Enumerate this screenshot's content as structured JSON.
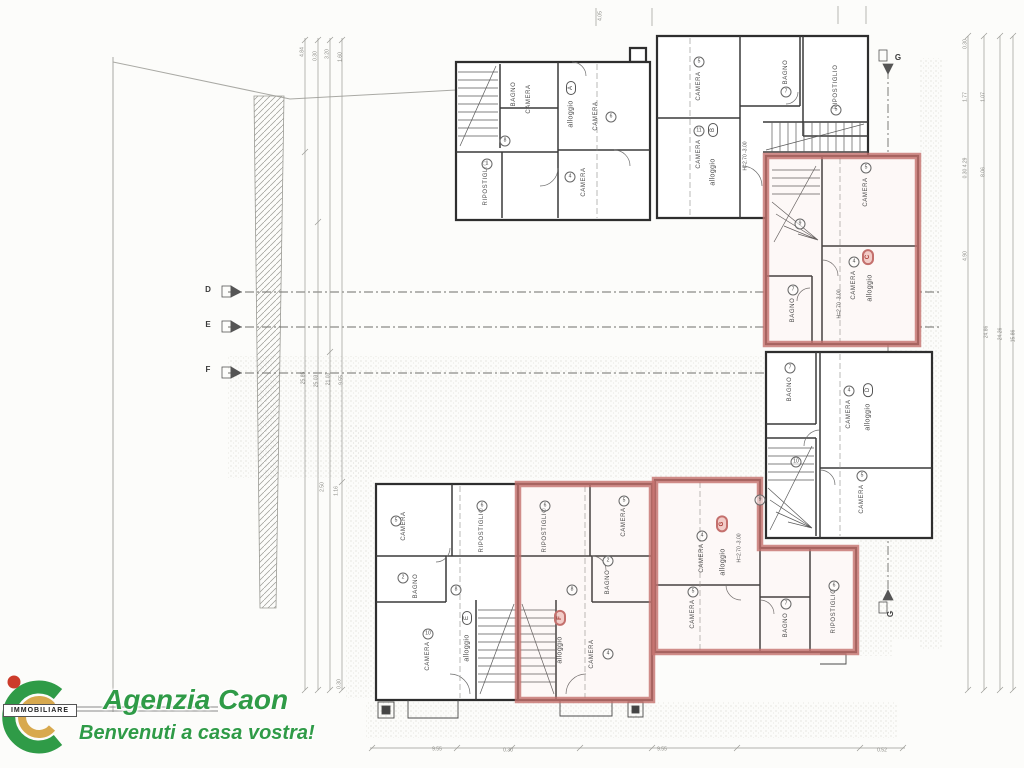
{
  "branding": {
    "agency_name": "Agenzia Caon",
    "tagline": "Benvenuti a casa vostra!",
    "logo_banner": "IMMOBILIARE",
    "brand_green": "#2f9b47",
    "brand_gold": "#d8a94e",
    "brand_red": "#cc3b2a"
  },
  "plan": {
    "type": "floor-plan-scan",
    "highlight_color": "#c4706d",
    "room_types": [
      "CAMERA",
      "BAGNO",
      "RIPOSTIGLIO",
      "alloggio"
    ],
    "highlighted_units": [
      "C",
      "F",
      "G"
    ],
    "labels": [
      {
        "t": "BAGNO",
        "x": 514,
        "y": 94,
        "r": -90,
        "cls": "room"
      },
      {
        "t": "CAMERA",
        "x": 529,
        "y": 99,
        "r": -90,
        "cls": "room"
      },
      {
        "t": "RIPOSTIGLIO",
        "x": 486,
        "y": 183,
        "r": -90,
        "cls": "room"
      },
      {
        "t": "CAMERA",
        "x": 584,
        "y": 182,
        "r": -90,
        "cls": "room"
      },
      {
        "t": "CAMERA",
        "x": 596,
        "y": 116,
        "r": -90,
        "cls": "room"
      },
      {
        "t": "alloggio",
        "x": 571,
        "y": 114,
        "r": -90,
        "cls": "allog"
      },
      {
        "t": "A",
        "x": 571,
        "y": 88,
        "r": -90,
        "cls": "mark"
      },
      {
        "t": "8",
        "x": 505,
        "y": 141,
        "cls": "circ"
      },
      {
        "t": "6",
        "x": 611,
        "y": 117,
        "cls": "circ"
      },
      {
        "t": "4",
        "x": 570,
        "y": 177,
        "cls": "circ"
      },
      {
        "t": "1",
        "x": 487,
        "y": 164,
        "cls": "circ"
      },
      {
        "t": "CAMERA",
        "x": 699,
        "y": 86,
        "r": -90,
        "cls": "room"
      },
      {
        "t": "CAMERA",
        "x": 699,
        "y": 154,
        "r": -90,
        "cls": "room"
      },
      {
        "t": "BAGNO",
        "x": 786,
        "y": 72,
        "r": -90,
        "cls": "room"
      },
      {
        "t": "RIPOSTIGLIO",
        "x": 836,
        "y": 87,
        "r": -90,
        "cls": "room"
      },
      {
        "t": "alloggio",
        "x": 713,
        "y": 172,
        "r": -90,
        "cls": "allog"
      },
      {
        "t": "B",
        "x": 713,
        "y": 130,
        "r": -90,
        "cls": "mark"
      },
      {
        "t": "H=2.70 -3.00",
        "x": 746,
        "y": 156,
        "r": -90,
        "cls": "hnote"
      },
      {
        "t": "5",
        "x": 699,
        "y": 62,
        "cls": "circ"
      },
      {
        "t": "11",
        "x": 699,
        "y": 131,
        "cls": "circ"
      },
      {
        "t": "7",
        "x": 786,
        "y": 92,
        "cls": "circ"
      },
      {
        "t": "5",
        "x": 836,
        "y": 110,
        "cls": "circ"
      },
      {
        "t": "CAMERA",
        "x": 866,
        "y": 192,
        "r": -90,
        "cls": "room"
      },
      {
        "t": "CAMERA",
        "x": 854,
        "y": 285,
        "r": -90,
        "cls": "room"
      },
      {
        "t": "BAGNO",
        "x": 793,
        "y": 310,
        "r": -90,
        "cls": "room"
      },
      {
        "t": "alloggio",
        "x": 870,
        "y": 288,
        "r": -90,
        "cls": "allog"
      },
      {
        "t": "C",
        "x": 868,
        "y": 257,
        "r": -90,
        "cls": "markred"
      },
      {
        "t": "H=2.70 -3.00",
        "x": 840,
        "y": 304,
        "r": -90,
        "cls": "hnote"
      },
      {
        "t": "5",
        "x": 866,
        "y": 168,
        "cls": "circ"
      },
      {
        "t": "4",
        "x": 854,
        "y": 262,
        "cls": "circ"
      },
      {
        "t": "7",
        "x": 793,
        "y": 290,
        "cls": "circ"
      },
      {
        "t": "9",
        "x": 800,
        "y": 224,
        "cls": "circ"
      },
      {
        "t": "BAGNO",
        "x": 790,
        "y": 389,
        "r": -90,
        "cls": "room"
      },
      {
        "t": "CAMERA",
        "x": 849,
        "y": 414,
        "r": -90,
        "cls": "room"
      },
      {
        "t": "alloggio",
        "x": 868,
        "y": 417,
        "r": -90,
        "cls": "allog"
      },
      {
        "t": "D",
        "x": 868,
        "y": 390,
        "r": -90,
        "cls": "mark"
      },
      {
        "t": "CAMERA",
        "x": 862,
        "y": 499,
        "r": -90,
        "cls": "room"
      },
      {
        "t": "7",
        "x": 790,
        "y": 368,
        "cls": "circ"
      },
      {
        "t": "4",
        "x": 849,
        "y": 391,
        "cls": "circ"
      },
      {
        "t": "5",
        "x": 862,
        "y": 476,
        "cls": "circ"
      },
      {
        "t": "10",
        "x": 796,
        "y": 462,
        "cls": "circ"
      },
      {
        "t": "CAMERA",
        "x": 404,
        "y": 526,
        "r": -90,
        "cls": "room"
      },
      {
        "t": "RIPOSTIGLIO",
        "x": 482,
        "y": 530,
        "r": -90,
        "cls": "room"
      },
      {
        "t": "BAGNO",
        "x": 416,
        "y": 586,
        "r": -90,
        "cls": "room"
      },
      {
        "t": "CAMERA",
        "x": 428,
        "y": 656,
        "r": -90,
        "cls": "room"
      },
      {
        "t": "alloggio",
        "x": 467,
        "y": 648,
        "r": -90,
        "cls": "allog"
      },
      {
        "t": "E",
        "x": 467,
        "y": 618,
        "r": -90,
        "cls": "mark"
      },
      {
        "t": "5",
        "x": 396,
        "y": 521,
        "cls": "circ"
      },
      {
        "t": "6",
        "x": 482,
        "y": 506,
        "cls": "circ"
      },
      {
        "t": "2",
        "x": 403,
        "y": 578,
        "cls": "circ"
      },
      {
        "t": "10",
        "x": 428,
        "y": 634,
        "cls": "circ"
      },
      {
        "t": "8",
        "x": 456,
        "y": 590,
        "cls": "circ"
      },
      {
        "t": "RIPOSTIGLIO",
        "x": 545,
        "y": 530,
        "r": -90,
        "cls": "room"
      },
      {
        "t": "CAMERA",
        "x": 624,
        "y": 522,
        "r": -90,
        "cls": "room"
      },
      {
        "t": "BAGNO",
        "x": 608,
        "y": 582,
        "r": -90,
        "cls": "room"
      },
      {
        "t": "CAMERA",
        "x": 592,
        "y": 654,
        "r": -90,
        "cls": "room"
      },
      {
        "t": "alloggio",
        "x": 560,
        "y": 650,
        "r": -90,
        "cls": "allog"
      },
      {
        "t": "F",
        "x": 560,
        "y": 618,
        "r": -90,
        "cls": "markred"
      },
      {
        "t": "6",
        "x": 545,
        "y": 506,
        "cls": "circ"
      },
      {
        "t": "5",
        "x": 624,
        "y": 501,
        "cls": "circ"
      },
      {
        "t": "2",
        "x": 608,
        "y": 561,
        "cls": "circ"
      },
      {
        "t": "8",
        "x": 572,
        "y": 590,
        "cls": "circ"
      },
      {
        "t": "4",
        "x": 608,
        "y": 654,
        "cls": "circ"
      },
      {
        "t": "CAMERA",
        "x": 702,
        "y": 558,
        "r": -90,
        "cls": "room"
      },
      {
        "t": "CAMERA",
        "x": 693,
        "y": 614,
        "r": -90,
        "cls": "room"
      },
      {
        "t": "alloggio",
        "x": 723,
        "y": 562,
        "r": -90,
        "cls": "allog"
      },
      {
        "t": "G",
        "x": 722,
        "y": 524,
        "r": -90,
        "cls": "markred"
      },
      {
        "t": "H=2.70 -3.00",
        "x": 740,
        "y": 548,
        "r": -90,
        "cls": "hnote"
      },
      {
        "t": "BAGNO",
        "x": 786,
        "y": 625,
        "r": -90,
        "cls": "room"
      },
      {
        "t": "RIPOSTIGLIO",
        "x": 834,
        "y": 611,
        "r": -90,
        "cls": "room"
      },
      {
        "t": "4",
        "x": 702,
        "y": 536,
        "cls": "circ"
      },
      {
        "t": "5",
        "x": 693,
        "y": 592,
        "cls": "circ"
      },
      {
        "t": "7",
        "x": 786,
        "y": 604,
        "cls": "circ"
      },
      {
        "t": "6",
        "x": 834,
        "y": 586,
        "cls": "circ"
      },
      {
        "t": "9",
        "x": 760,
        "y": 500,
        "cls": "circ"
      },
      {
        "t": "D",
        "x": 208,
        "y": 290,
        "cls": "sec"
      },
      {
        "t": "E",
        "x": 208,
        "y": 325,
        "cls": "sec"
      },
      {
        "t": "F",
        "x": 208,
        "y": 370,
        "cls": "sec"
      },
      {
        "t": "G",
        "x": 898,
        "y": 58,
        "cls": "sec"
      },
      {
        "t": "G",
        "x": 891,
        "y": 614,
        "r": -90,
        "cls": "sec"
      },
      {
        "t": "4.84",
        "x": 303,
        "y": 52,
        "r": -90,
        "cls": "dim"
      },
      {
        "t": "0.30",
        "x": 316,
        "y": 56,
        "r": -90,
        "cls": "dim"
      },
      {
        "t": "3.20",
        "x": 328,
        "y": 54,
        "r": -90,
        "cls": "dim"
      },
      {
        "t": "1.60",
        "x": 341,
        "y": 57,
        "r": -90,
        "cls": "dim"
      },
      {
        "t": "4.05",
        "x": 601,
        "y": 16,
        "r": -90,
        "cls": "dim"
      },
      {
        "t": "25.85",
        "x": 304,
        "y": 378,
        "r": -90,
        "cls": "dim"
      },
      {
        "t": "25.03",
        "x": 317,
        "y": 381,
        "r": -90,
        "cls": "dim"
      },
      {
        "t": "21.03",
        "x": 329,
        "y": 379,
        "r": -90,
        "cls": "dim"
      },
      {
        "t": "9.55",
        "x": 342,
        "y": 380,
        "r": -90,
        "cls": "dim"
      },
      {
        "t": "2.50",
        "x": 323,
        "y": 487,
        "r": -90,
        "cls": "dim"
      },
      {
        "t": "1.16",
        "x": 337,
        "y": 491,
        "r": -90,
        "cls": "dim"
      },
      {
        "t": "0.30",
        "x": 340,
        "y": 684,
        "r": -90,
        "cls": "dim"
      },
      {
        "t": "0.30",
        "x": 966,
        "y": 44,
        "r": -90,
        "cls": "dim"
      },
      {
        "t": "1.77",
        "x": 966,
        "y": 97,
        "r": -90,
        "cls": "dim"
      },
      {
        "t": "1.07",
        "x": 984,
        "y": 97,
        "r": -90,
        "cls": "dim"
      },
      {
        "t": "0.30 4.29",
        "x": 966,
        "y": 168,
        "r": -90,
        "cls": "dim"
      },
      {
        "t": "8.06",
        "x": 984,
        "y": 172,
        "r": -90,
        "cls": "dim"
      },
      {
        "t": "4.90",
        "x": 966,
        "y": 256,
        "r": -90,
        "cls": "dim"
      },
      {
        "t": "24.86",
        "x": 987,
        "y": 332,
        "r": -90,
        "cls": "dim"
      },
      {
        "t": "24.26",
        "x": 1001,
        "y": 334,
        "r": -90,
        "cls": "dim"
      },
      {
        "t": "15.86",
        "x": 1014,
        "y": 336,
        "r": -90,
        "cls": "dim"
      },
      {
        "t": "9.55",
        "x": 437,
        "y": 750,
        "cls": "dimh"
      },
      {
        "t": "0.30",
        "x": 508,
        "y": 751,
        "cls": "dimh"
      },
      {
        "t": "9.55",
        "x": 662,
        "y": 750,
        "cls": "dimh"
      },
      {
        "t": "0.52",
        "x": 882,
        "y": 751,
        "cls": "dimh"
      }
    ]
  }
}
